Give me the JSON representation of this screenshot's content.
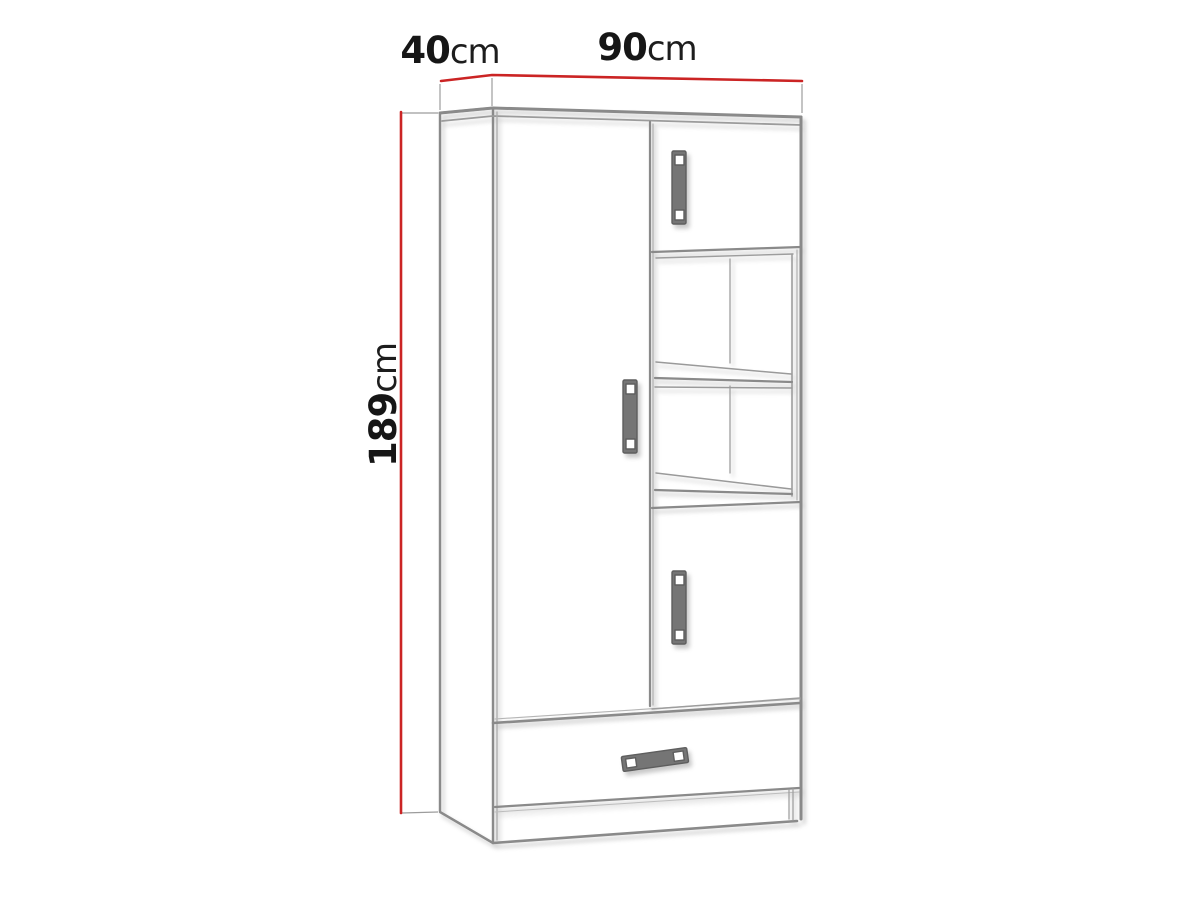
{
  "diagram": {
    "type": "furniture-dimension-drawing",
    "item": "wardrobe with side doors, open shelf niche and bottom drawer",
    "dimensions": {
      "depth": {
        "value": "40",
        "unit": "cm"
      },
      "width": {
        "value": "90",
        "unit": "cm"
      },
      "height": {
        "value": "189",
        "unit": "cm"
      }
    },
    "colors": {
      "dimension_line": "#cb2424",
      "outline": "#8a8a8a",
      "outline_light": "#a6a6a6",
      "handle_fill": "#757575",
      "handle_edge": "#5e5e5e",
      "text": "#161616",
      "background": "#ffffff"
    }
  }
}
